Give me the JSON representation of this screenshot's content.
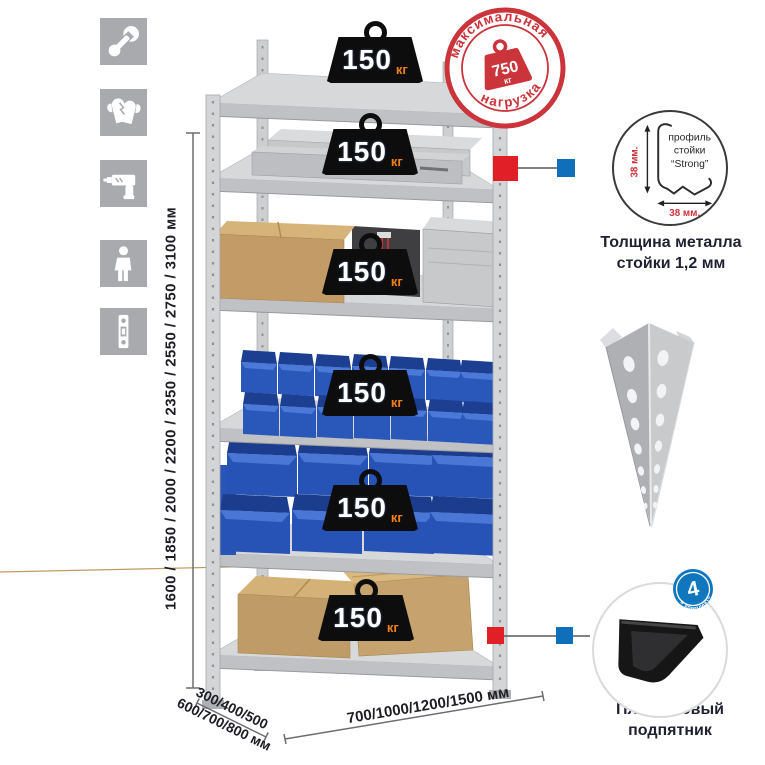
{
  "colors": {
    "stamp_red": "#cb343b",
    "marker_red": "#e11f26",
    "marker_blue": "#106fba",
    "bin_blue": "#2a57ba",
    "badge_unit_orange": "#f08019",
    "metal_gray": "#d6d8da",
    "icon_tile_gray": "#a8aaad"
  },
  "sidebar": {
    "icons": [
      "wrench-icon",
      "gloves-icon",
      "drill-icon",
      "person-icon",
      "rack-post-icon"
    ]
  },
  "rack": {
    "shelf_count": 6,
    "badges": [
      {
        "value": "150",
        "unit": "кг"
      },
      {
        "value": "150",
        "unit": "кг"
      },
      {
        "value": "150",
        "unit": "кг"
      },
      {
        "value": "150",
        "unit": "кг"
      },
      {
        "value": "150",
        "unit": "кг"
      },
      {
        "value": "150",
        "unit": "кг"
      }
    ]
  },
  "stamp": {
    "top_text": "максимальная",
    "bottom_text": "нагрузка",
    "value": "750",
    "unit": "кг"
  },
  "dimensions": {
    "height": "1600 / 1850 / 2000 / 2200 / 2350 / 2550 / 2750 / 3100 мм",
    "depth_line1": "300/400/500",
    "depth_line2": "600/700/800 мм",
    "width": "700/1000/1200/1500 мм"
  },
  "profile_callout": {
    "label_line1": "профиль",
    "label_line2": "стойки",
    "label_line3": "“Strong”",
    "dim_vertical": "38 мм.",
    "dim_horizontal": "38 мм.",
    "caption_line1": "Толщина металла",
    "caption_line2": "стойки 1,2 мм"
  },
  "foot_callout": {
    "badge_value": "4",
    "badge_ring_text": "в комплекте",
    "caption_line1": "Пластиковый",
    "caption_line2": "подпятник"
  }
}
